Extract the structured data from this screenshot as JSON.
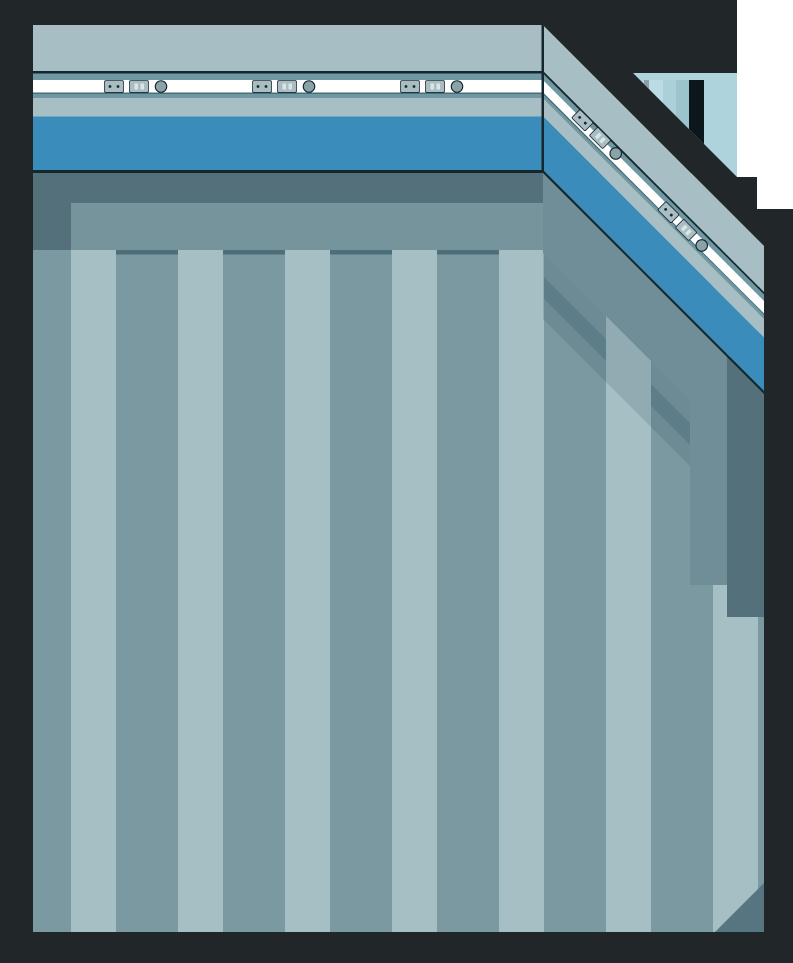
{
  "meta": {
    "description": "Stylized game background illustration: empty interior room corner with a blue wainscot wall band, power outlet strip, a glimpse of a doorway window at the top right, and a vertically striped floor seen in false perspective",
    "visible_text": ""
  },
  "colors": {
    "charcoal": "#212729",
    "page_white": "#ffffff",
    "outline": "#14262e",
    "wall_light": "#a7bfc4",
    "wall_teal": "#6f98a3",
    "wall_teal_line": "#486e79",
    "wall_white": "#ffffff",
    "wall_blue": "#3a8cbb",
    "window_sky": "#aed3dd",
    "window_strip_dark": "#8b9fa6",
    "window_strip_light": "#bcdce5",
    "window_strip_mid": "#abd0da",
    "window_strip_mid2": "#9cc4cf",
    "window_door": "#0c171b",
    "floor_light": "#a5bfc4",
    "floor_dark": "#7b99a1",
    "floor_shadow_dark": "#53707b",
    "floor_shadow_mid": "#76949b",
    "floor_shadow_diag": "#6f8e97",
    "floor_cap": "#4e6e79",
    "floor_cap_diag": "#5d7d88",
    "floor_shadow_soft": "rgba(40,66,78,0.16)",
    "corner_shadow": "#567580",
    "plate_fill": "#a9bec3",
    "plate_slot": "#d9e5e7",
    "knob_fill": "#8ba2a9"
  },
  "icons": [
    {
      "name": "power-outlet-two-pin-icon",
      "shape": "rounded plate with two dark pin holes"
    },
    {
      "name": "power-outlet-slot-icon",
      "shape": "rounded plate with two light vertical slots"
    },
    {
      "name": "round-button-icon",
      "shape": "small outlined circle"
    }
  ],
  "scene": {
    "front_wall_outlet_groups": 3,
    "side_wall_outlet_groups": 2,
    "floor_stripe_count": 15,
    "walls": [
      "front-wall",
      "side-wall-diagonal"
    ],
    "features": [
      "wainscot-blue-band",
      "outlet-strip",
      "doorway-window-glimpse",
      "striped-floor",
      "wall-shadows"
    ]
  }
}
